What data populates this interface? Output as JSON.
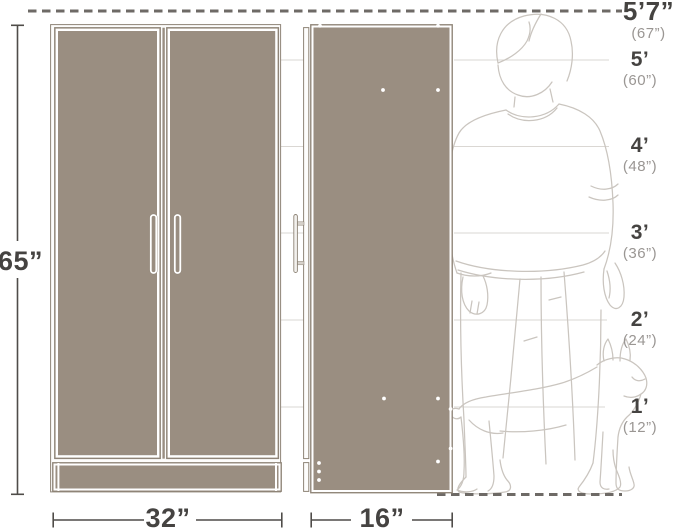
{
  "cabinet": {
    "height_label": "65”",
    "width_label": "32”",
    "depth_label": "16”"
  },
  "height_scale": {
    "markers": [
      {
        "label": "5’7”",
        "sub": "(67”)"
      },
      {
        "label": "5’",
        "sub": "(60”)"
      },
      {
        "label": "4’",
        "sub": "(48”)"
      },
      {
        "label": "3’",
        "sub": "(36”)"
      },
      {
        "label": "2’",
        "sub": "(24”)"
      },
      {
        "label": "1’",
        "sub": "(12”)"
      }
    ]
  },
  "colors": {
    "cabinet_fill": "#9a8e81",
    "cabinet_edge": "#8e8477",
    "dimension_line": "#4f4c49",
    "marker_label": "#454341",
    "marker_sub": "#9a9693",
    "gridline": "#dad7d3",
    "dashed_line": "#6e6a66",
    "silhouette": "#cac5bf"
  }
}
